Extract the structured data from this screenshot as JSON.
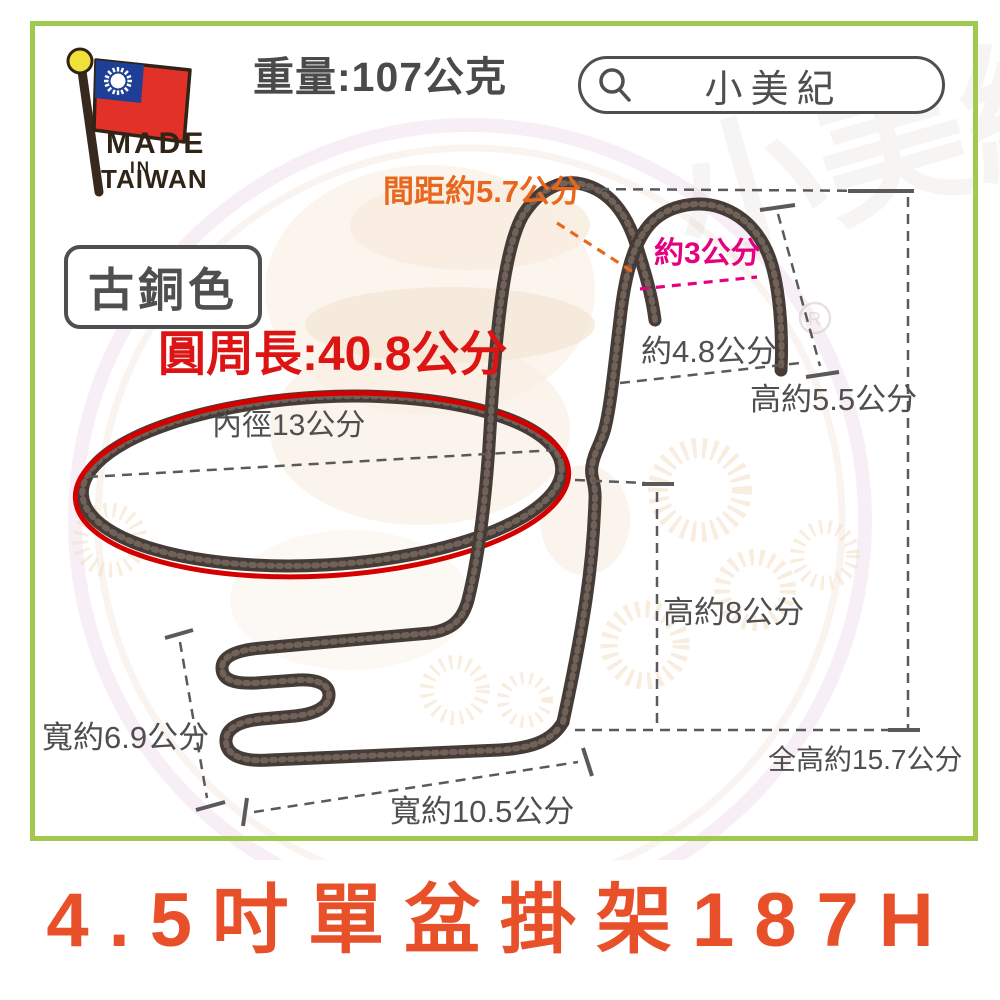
{
  "header": {
    "weight_label": "重量:107公克",
    "search": {
      "brand": "小美紀"
    },
    "made_in": {
      "line1": "MADE",
      "line2": "IN",
      "line3": "TAIWAN"
    }
  },
  "badges": {
    "color_name": "古銅色"
  },
  "annotations": {
    "circumference": "圓周長:40.8公分",
    "gap": "間距約5.7公分",
    "hook_gap": "約3公分",
    "hook_depth": "約4.8公分",
    "hook_height": "高約5.5公分",
    "inner_diameter": "內徑13公分",
    "body_height": "高約8公分",
    "total_height": "全高約15.7公分",
    "bracket_width": "寬約6.9公分",
    "base_width": "寬約10.5公分"
  },
  "footer": {
    "title": "4.5吋單盆掛架187H"
  },
  "colors": {
    "frame_green": "#A2C94F",
    "title_orange": "#E8502A",
    "label_gray": "#4F4F4F",
    "circumference_red": "#DD1414",
    "gap_orange": "#E8671C",
    "hook_gap_magenta": "#E4007F",
    "ring_highlight_red": "#D40000",
    "wire_bronze": "#453C37",
    "flag_red": "#E23128",
    "flag_blue": "#1E3F96"
  }
}
